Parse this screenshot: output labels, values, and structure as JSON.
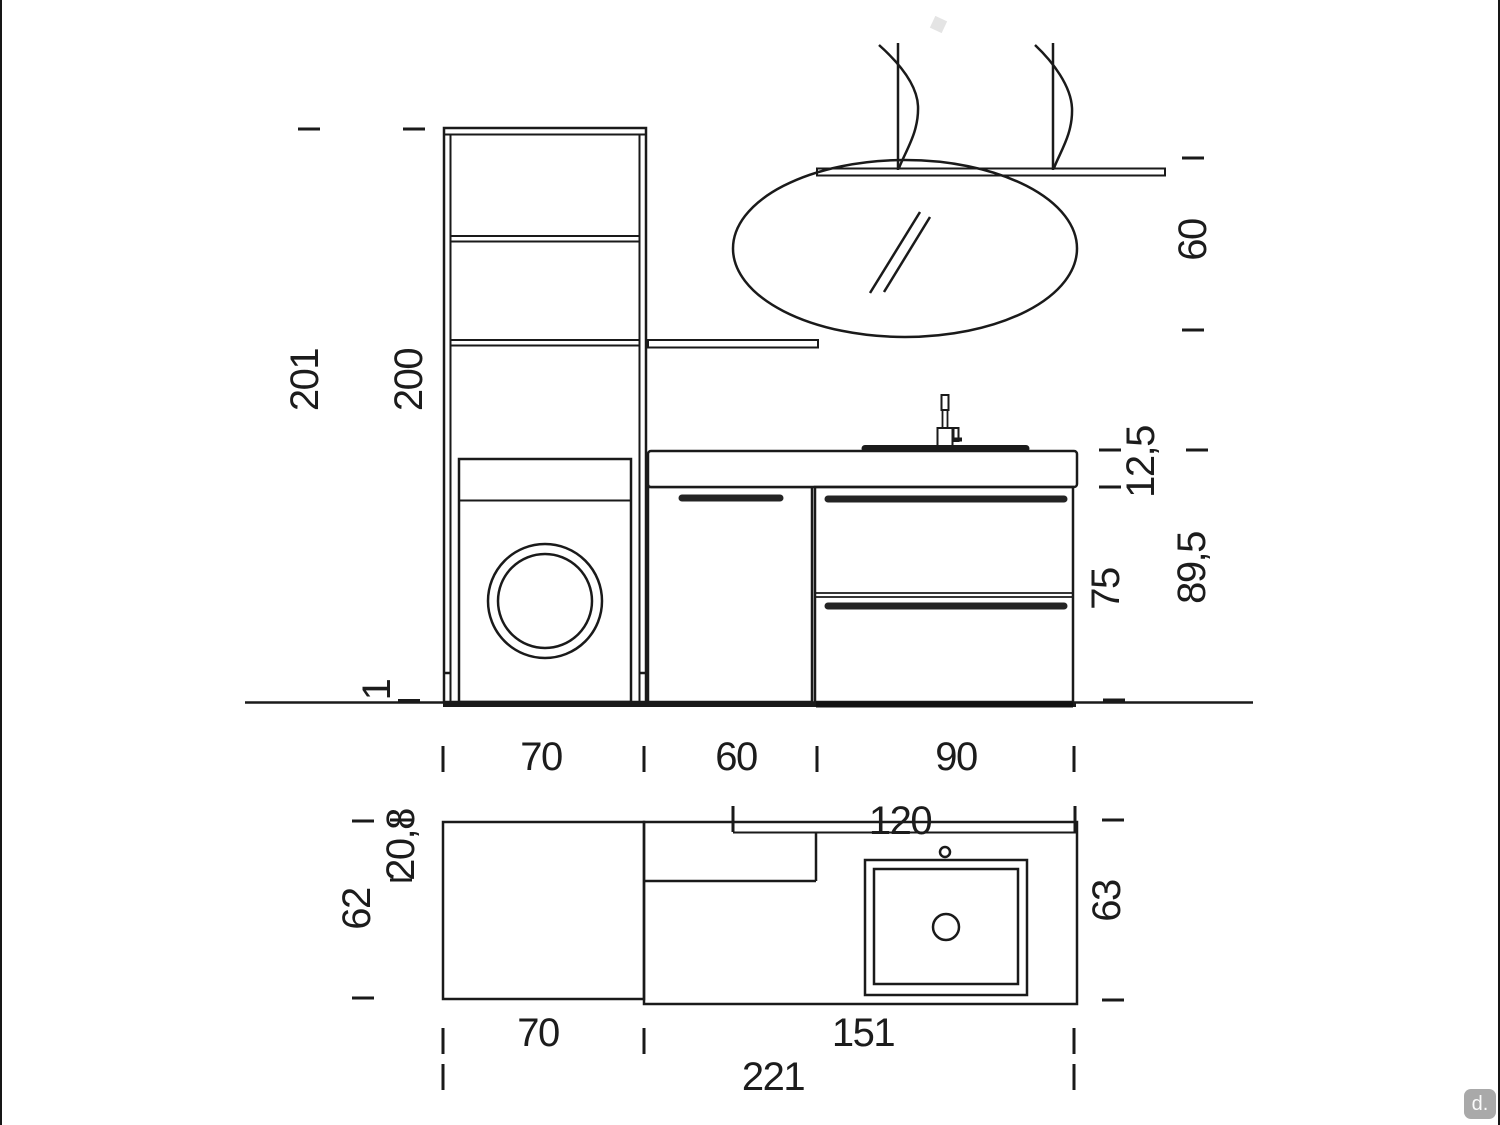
{
  "badge": {
    "text": "d."
  },
  "elevation": {
    "vertical_dims": {
      "total_height": "201",
      "column_height": "200",
      "plinth_height": "1",
      "mirror_height": "60",
      "worktop_and_basin_height": "12,5",
      "total_unit_height": "89,5",
      "base_unit_height": "75"
    },
    "horizontal_dims": {
      "washer_column_width": "70",
      "door_unit_width": "60",
      "drawer_unit_width": "90",
      "basin_top_width": "120"
    }
  },
  "plan": {
    "vertical_dims": {
      "washer_bay_depth": "62",
      "upper_shelf_depth": "20,8",
      "worktop_depth": "63"
    },
    "horizontal_dims": {
      "washer_bay_width": "70",
      "worktop_width": "151",
      "total_width": "221"
    }
  }
}
